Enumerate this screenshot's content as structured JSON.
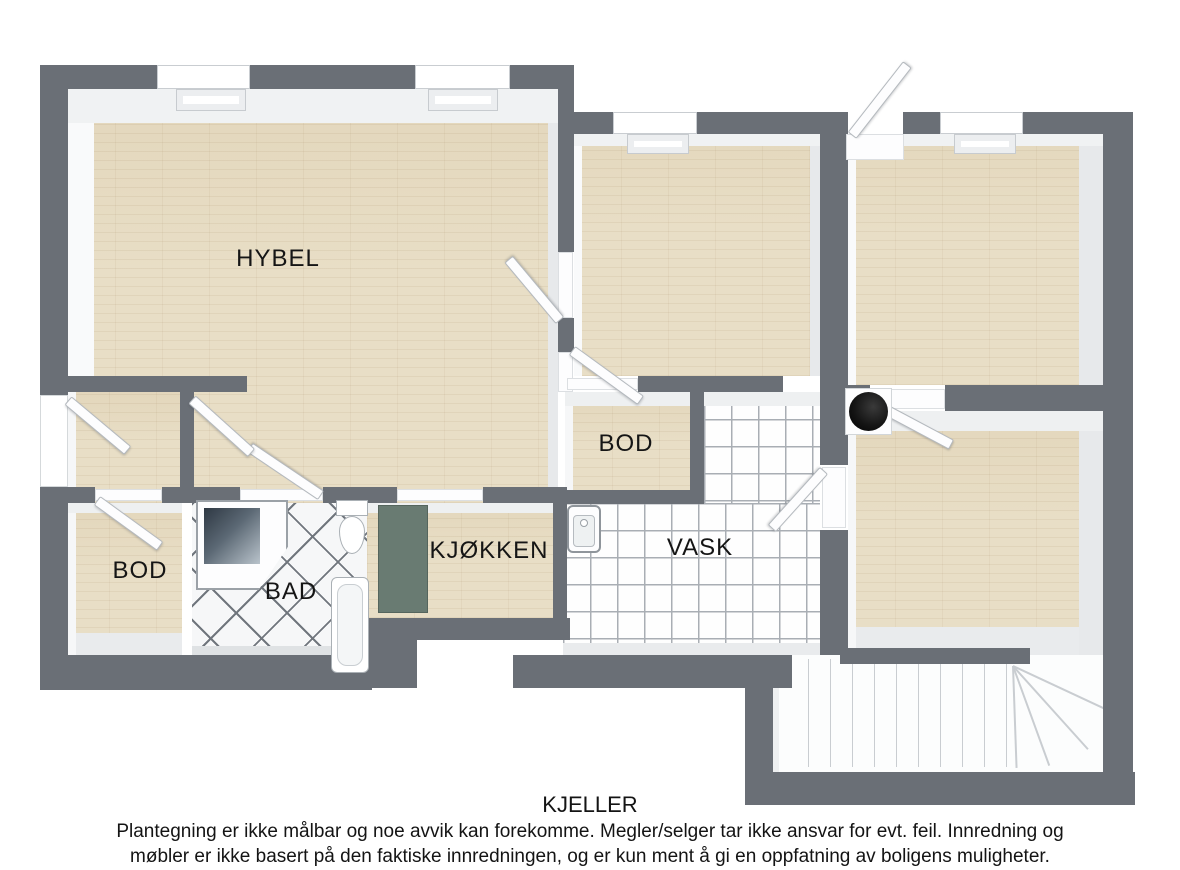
{
  "floorplan": {
    "floor_title": "KJELLER",
    "disclaimer_line1": "Plantegning er ikke målbar og noe avvik kan forekomme. Megler/selger tar ikke ansvar for evt. feil. Innredning og",
    "disclaimer_line2": "møbler er ikke basert på den faktiske innredningen, og er kun ment å gi en oppfatning av boligens muligheter.",
    "rooms": {
      "hybel": {
        "label": "HYBEL"
      },
      "bod_mid": {
        "label": "BOD"
      },
      "bod_left": {
        "label": "BOD"
      },
      "bad": {
        "label": "BAD"
      },
      "kjokken": {
        "label": "KJØKKEN"
      },
      "vask": {
        "label": "VASK"
      }
    },
    "fixtures": [
      "corner-shower",
      "toilet",
      "bathtub",
      "laundry-sink",
      "kitchen-counter",
      "water-heater",
      "staircase",
      "doors",
      "windows"
    ],
    "colors": {
      "wall": "#6a6f76",
      "wood_floor": "#e8dec6",
      "tile_line": "#a9aeb4",
      "bad_tile_line": "#70767d",
      "counter_teal": "#697b72",
      "water_heater": "#151515",
      "text": "#141414"
    }
  }
}
